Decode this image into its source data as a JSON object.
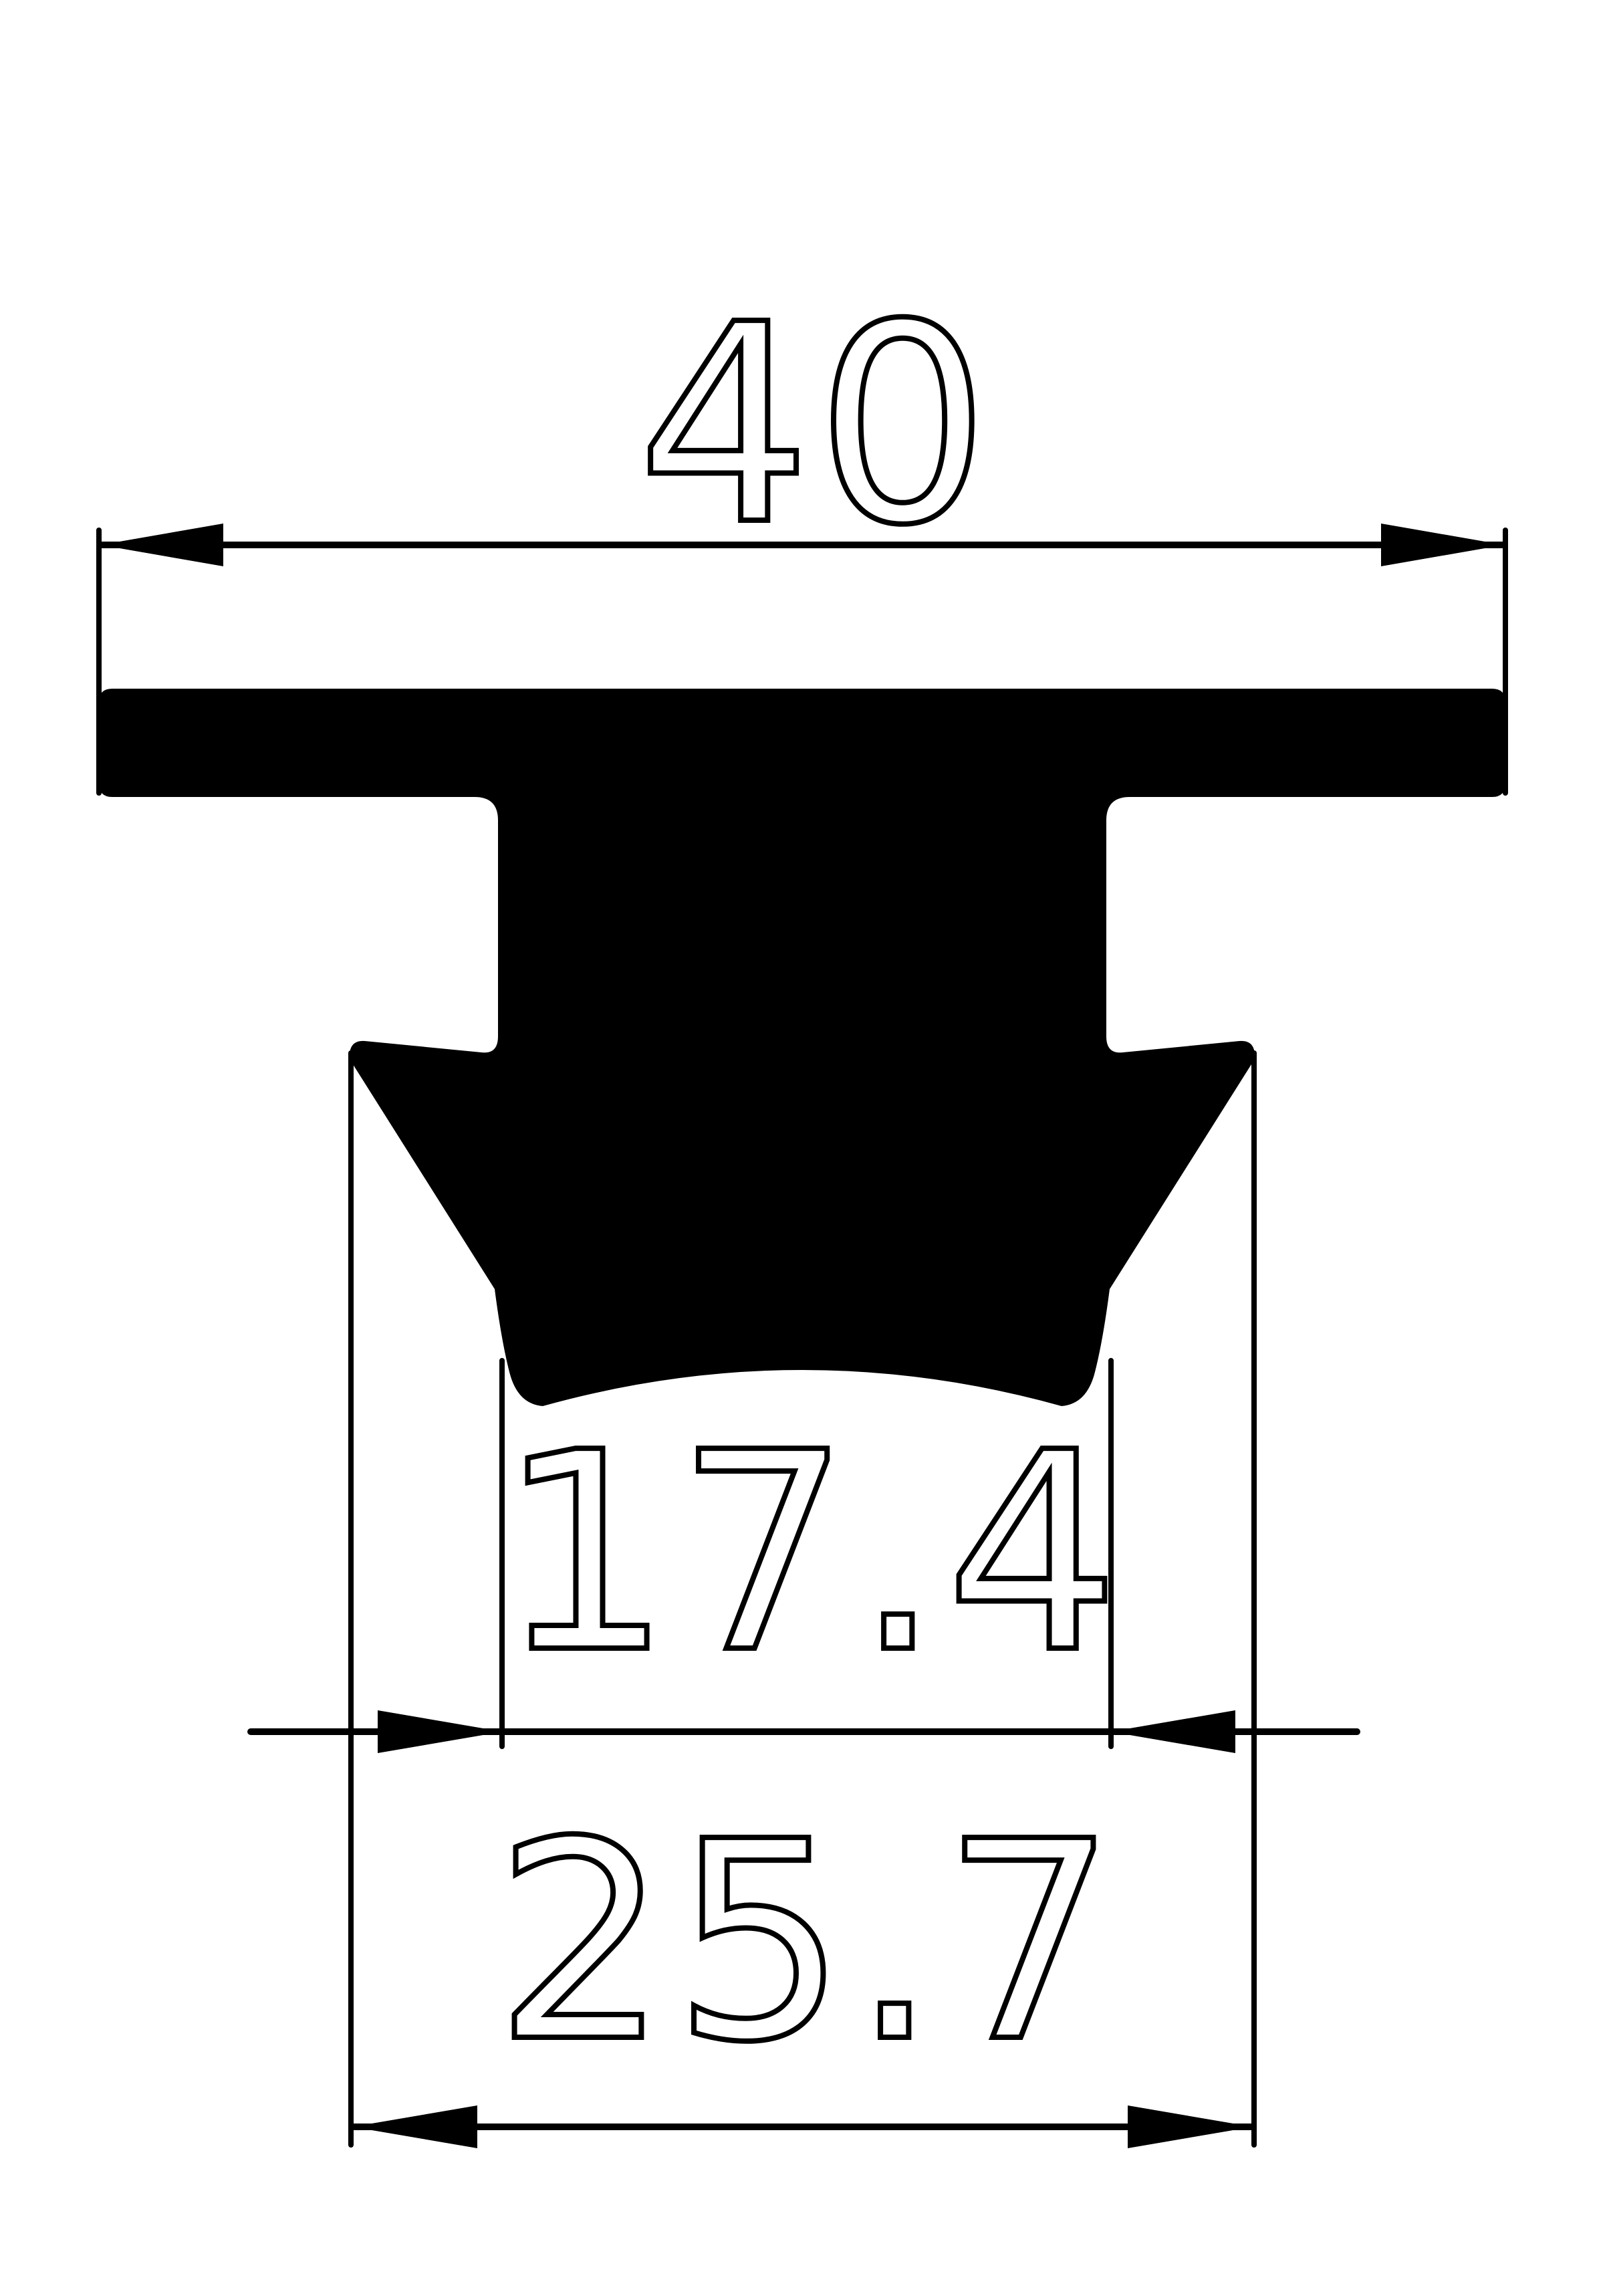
{
  "drawing": {
    "title": "rubber-profile-cross-section",
    "background_color": "#ffffff",
    "line_color": "#000000",
    "profile_fill": "#000000",
    "dimensions": {
      "overall_width": {
        "label": "40",
        "orientation": "horizontal",
        "position": "top"
      },
      "groove_width": {
        "label": "17.4",
        "orientation": "horizontal",
        "position": "middle"
      },
      "base_width": {
        "label": "25.7",
        "orientation": "horizontal",
        "position": "bottom"
      }
    }
  }
}
